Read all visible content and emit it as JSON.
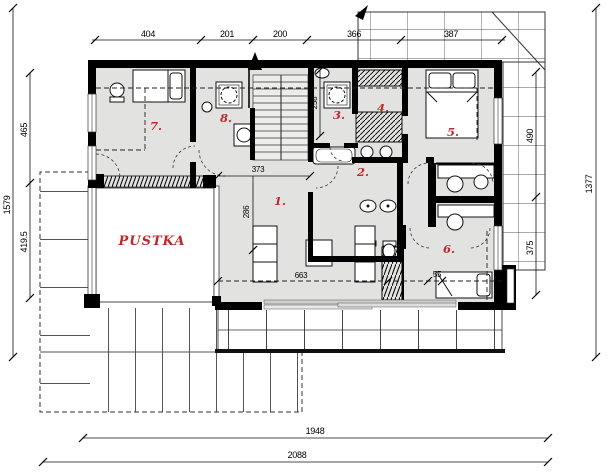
{
  "drawing": {
    "kind": "attic-floor-plan",
    "void_label": "PUSTKA",
    "room_numbers": [
      "1.",
      "2.",
      "3.",
      "4.",
      "5.",
      "6.",
      "7.",
      "8."
    ],
    "dimensions": {
      "top": [
        "404",
        "201",
        "200",
        "366",
        "387"
      ],
      "left_outer": "1579",
      "left_inner": [
        "465",
        "419.5"
      ],
      "right_outer": "1377",
      "right_inner": [
        "490",
        "375"
      ],
      "bottom": [
        "1948",
        "2088"
      ],
      "interior": [
        "373",
        "286",
        "258",
        "663",
        "55"
      ]
    },
    "colors": {
      "floor": "#e2e2e0",
      "wall": "#000000",
      "label_red": "#c0282b",
      "roof_line": "#555555"
    }
  }
}
